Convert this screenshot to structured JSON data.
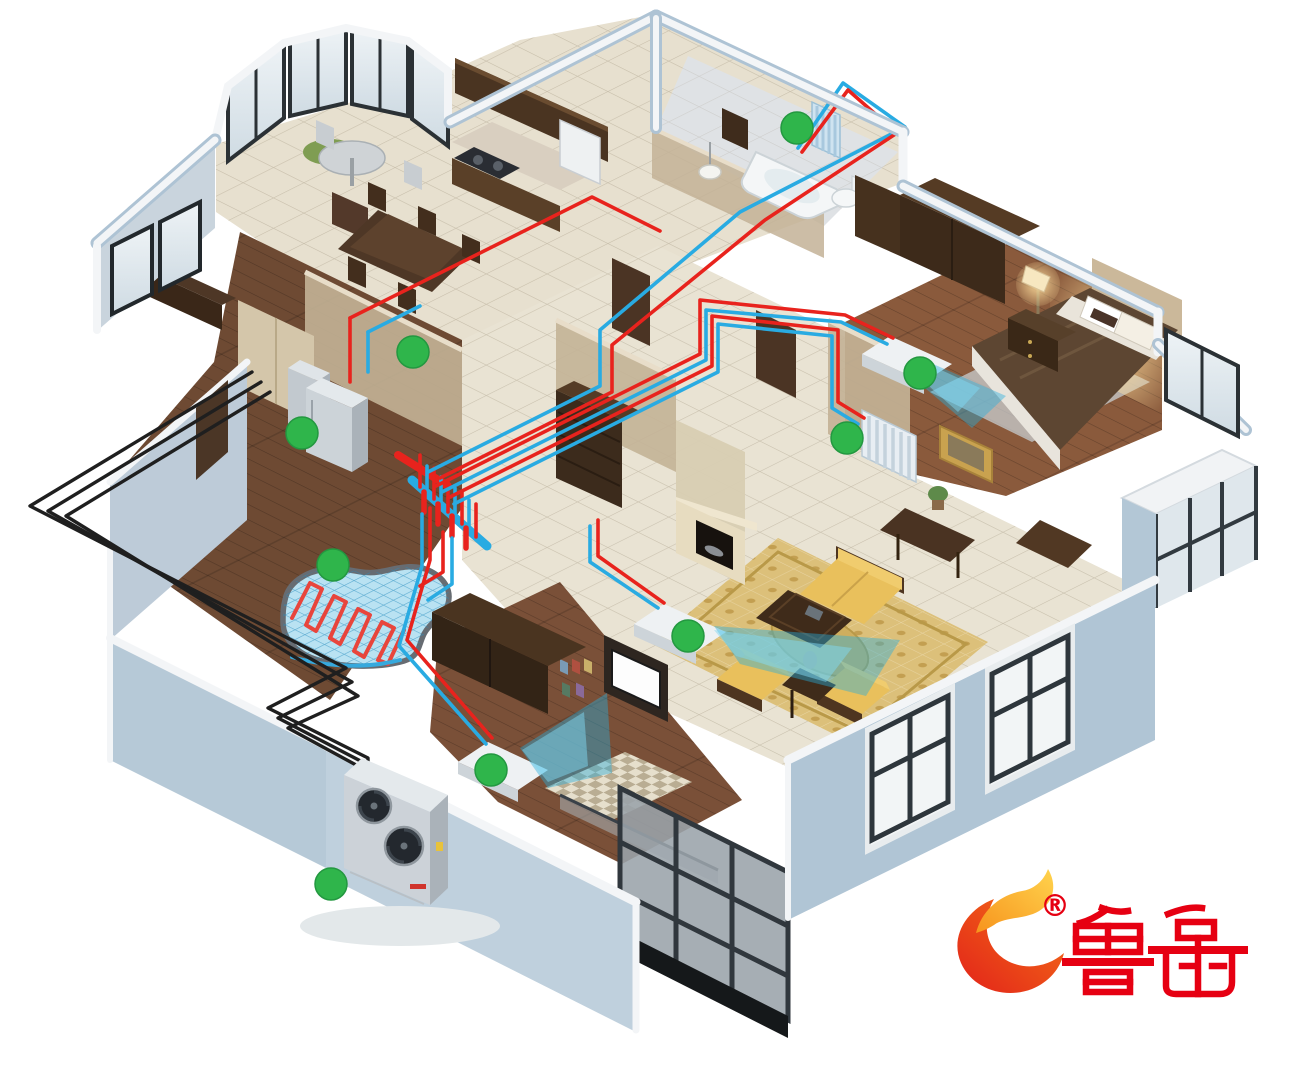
{
  "scene": {
    "type": "isometric-cutaway-house-heating-diagram",
    "background": "#ffffff"
  },
  "logo": {
    "brand_text": "鲁禹",
    "registered_mark": "®"
  },
  "colors": {
    "pipe_supply": "#e8231d",
    "pipe_return": "#29abe2",
    "pipe_outdoor": "#1f1f1f",
    "marker": "#2fb54b",
    "airflow": "#27aede",
    "wall_exterior": "#aec3d4",
    "wall_top": "#f3f5f7",
    "wall_interior": "#c3b296",
    "floor_tile": "#e9e3d3",
    "floor_wood": "#6e4a33",
    "rug": "#dcc07a",
    "heat_mat": "#b9e2f2",
    "equipment_silver": "#c6ccd2",
    "logo_red": "#e60012",
    "flame_orange": "#f7941d",
    "flame_yellow": "#ffd34d"
  },
  "system": {
    "components": [
      "outdoor-heat-pump-unit",
      "indoor-unit",
      "distribution-manifold",
      "underfloor-heating-coil",
      "bathroom-radiator",
      "bedroom-radiator",
      "fan-coil-units",
      "supply-pipes",
      "return-pipes"
    ]
  },
  "markers": [
    {
      "location": "bathroom-radiator",
      "x": 797,
      "y": 128
    },
    {
      "location": "entry-hallway",
      "x": 413,
      "y": 352
    },
    {
      "location": "utility-indoor-unit",
      "x": 302,
      "y": 433
    },
    {
      "location": "bedroom-fan-coil",
      "x": 920,
      "y": 373
    },
    {
      "location": "hallway-bedroom-radiator",
      "x": 847,
      "y": 438
    },
    {
      "location": "floor-heating-room",
      "x": 333,
      "y": 565
    },
    {
      "location": "living-room-fan-coil",
      "x": 688,
      "y": 636
    },
    {
      "location": "south-bedroom-fan-coil",
      "x": 491,
      "y": 770
    },
    {
      "location": "outdoor-unit",
      "x": 331,
      "y": 884
    }
  ]
}
